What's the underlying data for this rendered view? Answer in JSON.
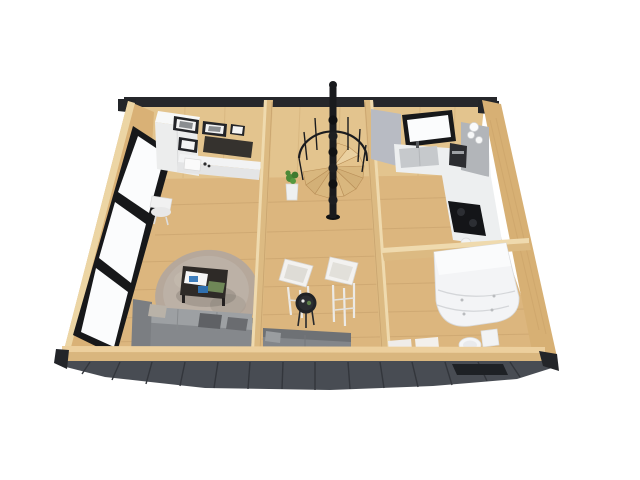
{
  "scene": {
    "type": "3d-render-floorplan-cutaway",
    "subject": "small cabin interior, top-down isometric cutaway view on white background",
    "rooms": [
      {
        "name": "living-room",
        "objects": [
          "wall-cabinet",
          "picture-frames",
          "tv-panel",
          "desk",
          "desk-chair",
          "fluffy-rug",
          "coffee-table",
          "books",
          "corner-sofa",
          "pillows",
          "panoramic-windows"
        ]
      },
      {
        "name": "hall",
        "objects": [
          "spiral-staircase",
          "potted-plant",
          "armchair-left",
          "armchair-right",
          "round-side-table",
          "bench-sofa"
        ]
      },
      {
        "name": "kitchen",
        "objects": [
          "window",
          "sink-counter",
          "right-counter",
          "cooktop",
          "coffee-machine",
          "cups",
          "gray-shelf",
          "gray-wall-panel"
        ]
      },
      {
        "name": "bathroom",
        "objects": [
          "corner-shower-vanity-unit",
          "toilet",
          "bath-mats",
          "doormat"
        ]
      }
    ],
    "exterior": [
      "dark-wall-cap",
      "dark-front-deck",
      "wood-log-walls",
      "stair-pole-above-roof"
    ]
  },
  "palette": {
    "background": "#ffffff",
    "deck": "#484c53",
    "deck_mat": "#1e2125",
    "cap_dark": "#26272b",
    "trim_dark": "#232529",
    "floor_wood": "#dcb67e",
    "wall_wood": "#e3c48e",
    "wall_wood_outer": "#d9b176",
    "wall_edge_light": "#ecd5a4",
    "partition_wood": "#dcba82",
    "partition_cap": "#efdaae",
    "right_wall_wood": "#d7b074",
    "bottom_wall_wood": "#d9b67e",
    "bottom_wall_cap": "#eccf9d",
    "window_frame": "#17181a",
    "glass_white": "#fbfcfd",
    "white_furniture": "#f2f3f4",
    "white_soft": "#eceded",
    "counter_white": "#edeff0",
    "sink_gray": "#c6c9cc",
    "shelf_gray": "#b2b5b9",
    "gray_panel": "#b8bbc3",
    "appliance_dark": "#2c2d31",
    "cooktop_black": "#141518",
    "tv_dark": "#35322e",
    "photo_gray": "#8a8d90",
    "sofa_gray": "#85888c",
    "sofa_back_gray": "#9da0a3",
    "sofa_arm_gray": "#7b7e82",
    "sofa_dark": "#74777b",
    "bench_gray": "#83868a",
    "bench_back": "#6e7175",
    "pillow_beige": "#b9b2a8",
    "pillow_dark": "#5f6165",
    "rug_taupe": "#b3a89d",
    "rug_light": "#bcb1a6",
    "table_dark": "#2e2a27",
    "stair_black": "#191a1d",
    "tread_wood": "#d9b77e",
    "plant_green": "#4c8a38",
    "book_blue": "#3f7fbe",
    "book_green": "#6f8757",
    "bath_white": "#f3f4f6",
    "mat_white": "#efece9"
  }
}
